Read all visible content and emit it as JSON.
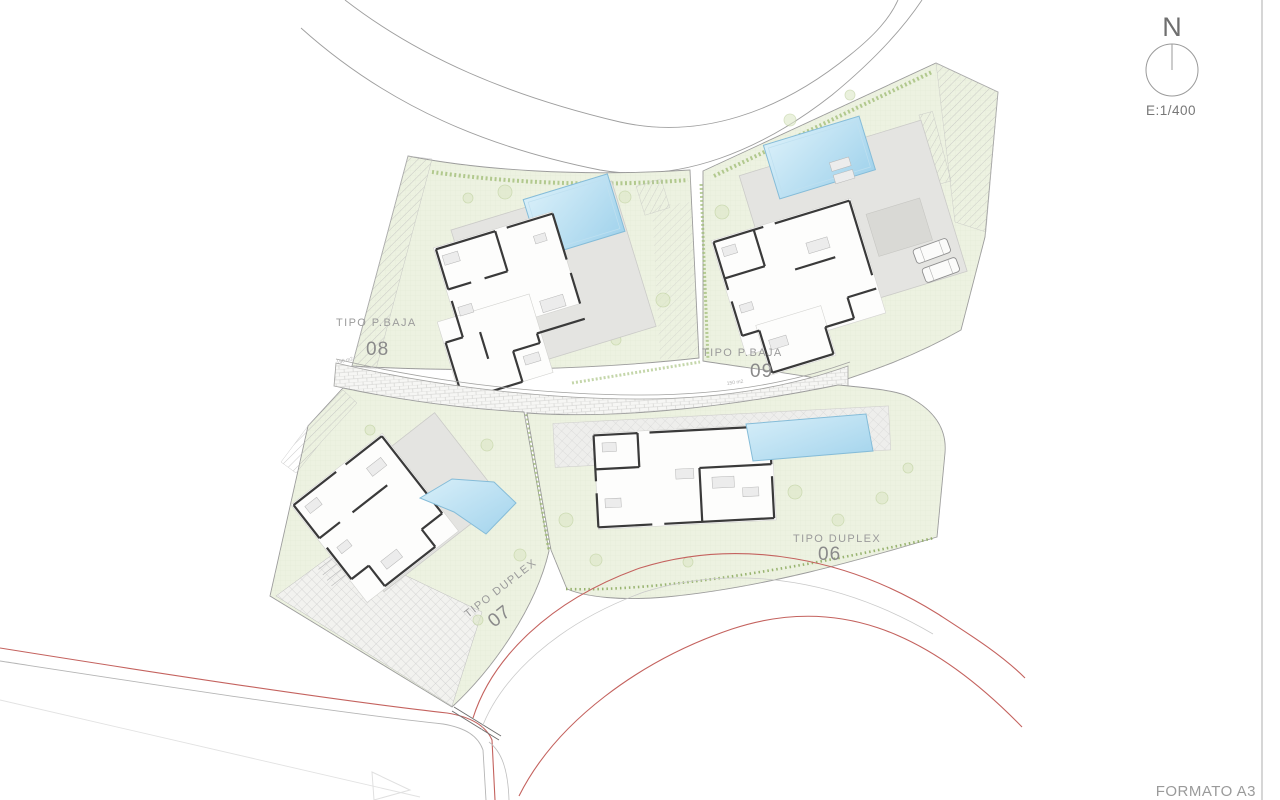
{
  "north_indicator": {
    "label": "N",
    "scale_label": "E:1/400"
  },
  "title_block": {
    "format_label": "FORMATO A3"
  },
  "plots": [
    {
      "number": "08",
      "type_label": "TIPO P.BAJA",
      "area_label": "150 m2"
    },
    {
      "number": "09",
      "type_label": "TIPO P.BAJA",
      "area_label": "150 m2"
    },
    {
      "number": "07",
      "type_label": "TIPO DUPLEX"
    },
    {
      "number": "06",
      "type_label": "TIPO DUPLEX"
    }
  ],
  "legend_colors": {
    "road_red": "#c4625e",
    "pool_blue": "#aed8ee",
    "garden_green": "#edf2e1",
    "terrace_grey": "#e4e4e1",
    "hedge_green": "#9dbb72",
    "wall_dark": "#3a3a3a",
    "line_grey": "#a5a5a5"
  }
}
